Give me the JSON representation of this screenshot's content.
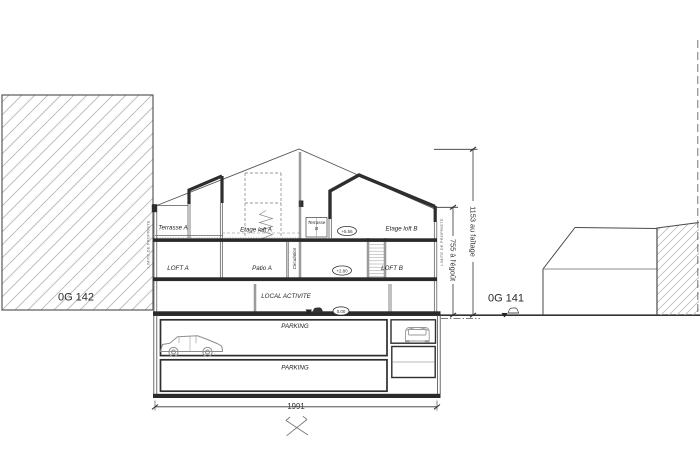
{
  "drawing": {
    "type": "architectural-section",
    "parcels": {
      "left": "0G 142",
      "right": "0G 141"
    },
    "rooms": {
      "terrasse_a": "Terrasse A",
      "etage_loft_a": "Etage loft A",
      "terrasse_b_line1": "Terrasse",
      "terrasse_b_line2": "B",
      "etage_loft_b": "Etage loft B",
      "loft_a": "LOFT A",
      "patio_a": "Patio A",
      "circulation": "Circulation",
      "loft_b": "LOFT B",
      "local_activite": "LOCAL ACTIVITE",
      "parking_upper": "PARKING",
      "parking_lower": "PARKING"
    },
    "levels": {
      "etage": "+5.56",
      "loft": "+2.80",
      "ground": "0.00"
    },
    "dimensions": {
      "ridge_height": "1153 au faîtage",
      "eaves_height": "755 à l'égoût",
      "overall_width": "1991"
    },
    "boundaries": {
      "limite_left": "LIMITE DE PROPRIETE",
      "limite_right": "LIMITE DE PROPRIETE"
    },
    "colors": {
      "ink": "#2e2e2e",
      "thin_line": "#555555",
      "hatch": "#b8b8b8",
      "background": "#ffffff"
    }
  }
}
